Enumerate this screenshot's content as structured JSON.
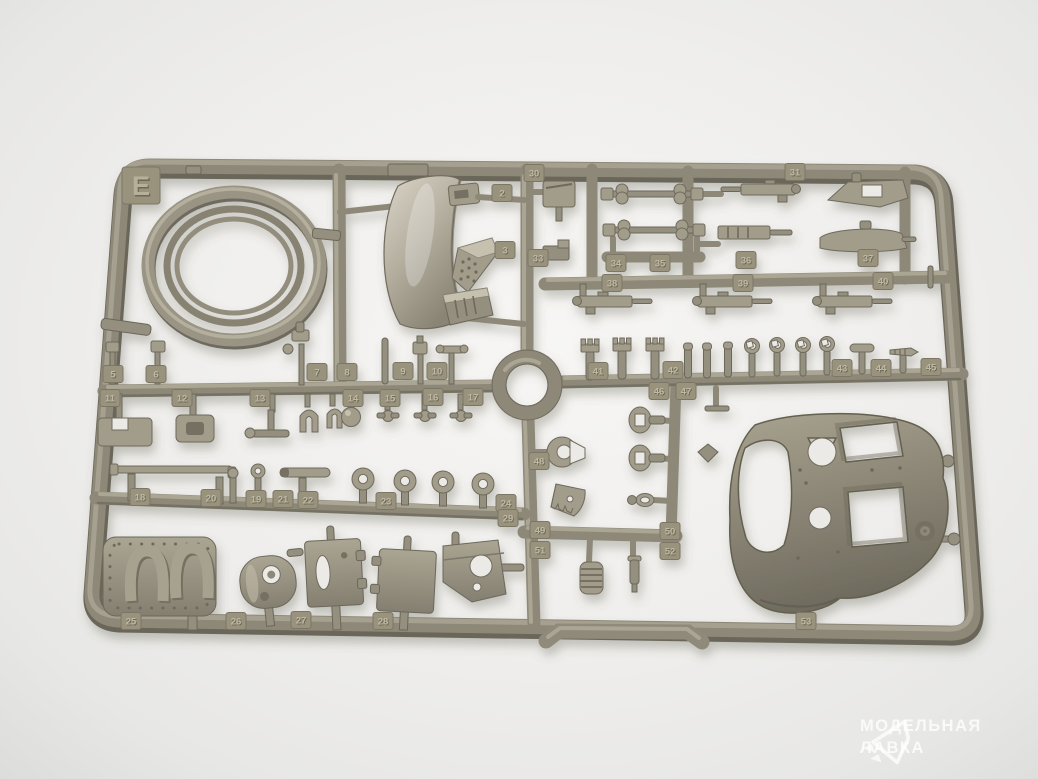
{
  "photo": {
    "background_color": "#ebebe9",
    "subject": "olive plastic model kit sprue"
  },
  "sprue": {
    "letter": "E",
    "plastic_color": "#938e7e",
    "part_tags": [
      {
        "label": "2",
        "x": 502,
        "y": 193
      },
      {
        "label": "3",
        "x": 505,
        "y": 250
      },
      {
        "label": "30",
        "x": 534,
        "y": 173
      },
      {
        "label": "31",
        "x": 795,
        "y": 172
      },
      {
        "label": "33",
        "x": 538,
        "y": 258
      },
      {
        "label": "34",
        "x": 616,
        "y": 263
      },
      {
        "label": "35",
        "x": 660,
        "y": 263
      },
      {
        "label": "36",
        "x": 746,
        "y": 260
      },
      {
        "label": "37",
        "x": 868,
        "y": 258
      },
      {
        "label": "38",
        "x": 612,
        "y": 283
      },
      {
        "label": "39",
        "x": 743,
        "y": 283
      },
      {
        "label": "40",
        "x": 883,
        "y": 281
      },
      {
        "label": "5",
        "x": 113,
        "y": 374
      },
      {
        "label": "6",
        "x": 156,
        "y": 374
      },
      {
        "label": "7",
        "x": 317,
        "y": 372
      },
      {
        "label": "8",
        "x": 347,
        "y": 372
      },
      {
        "label": "9",
        "x": 403,
        "y": 371
      },
      {
        "label": "10",
        "x": 437,
        "y": 371
      },
      {
        "label": "11",
        "x": 110,
        "y": 398
      },
      {
        "label": "12",
        "x": 182,
        "y": 398
      },
      {
        "label": "13",
        "x": 260,
        "y": 398
      },
      {
        "label": "14",
        "x": 353,
        "y": 398
      },
      {
        "label": "15",
        "x": 390,
        "y": 398
      },
      {
        "label": "16",
        "x": 433,
        "y": 397
      },
      {
        "label": "17",
        "x": 473,
        "y": 397
      },
      {
        "label": "41",
        "x": 598,
        "y": 371
      },
      {
        "label": "42",
        "x": 673,
        "y": 370
      },
      {
        "label": "43",
        "x": 842,
        "y": 368
      },
      {
        "label": "44",
        "x": 881,
        "y": 368
      },
      {
        "label": "45",
        "x": 931,
        "y": 367
      },
      {
        "label": "46",
        "x": 659,
        "y": 391
      },
      {
        "label": "47",
        "x": 686,
        "y": 391
      },
      {
        "label": "18",
        "x": 140,
        "y": 497
      },
      {
        "label": "20",
        "x": 211,
        "y": 498
      },
      {
        "label": "19",
        "x": 256,
        "y": 499
      },
      {
        "label": "21",
        "x": 283,
        "y": 499
      },
      {
        "label": "22",
        "x": 308,
        "y": 500
      },
      {
        "label": "23",
        "x": 386,
        "y": 501
      },
      {
        "label": "24",
        "x": 506,
        "y": 503
      },
      {
        "label": "48",
        "x": 539,
        "y": 461
      },
      {
        "label": "49",
        "x": 540,
        "y": 530
      },
      {
        "label": "50",
        "x": 670,
        "y": 531
      },
      {
        "label": "51",
        "x": 540,
        "y": 550
      },
      {
        "label": "52",
        "x": 670,
        "y": 551
      },
      {
        "label": "25",
        "x": 131,
        "y": 621
      },
      {
        "label": "26",
        "x": 236,
        "y": 621
      },
      {
        "label": "27",
        "x": 301,
        "y": 620
      },
      {
        "label": "28",
        "x": 383,
        "y": 621
      },
      {
        "label": "29",
        "x": 508,
        "y": 518
      },
      {
        "label": "53",
        "x": 806,
        "y": 621
      }
    ]
  },
  "watermark": {
    "logo_icon": "paper-plane-icon",
    "line1": "МОДЕЛЬНАЯ",
    "line2": "ЛАВКА",
    "text_color": "#ffffff"
  }
}
